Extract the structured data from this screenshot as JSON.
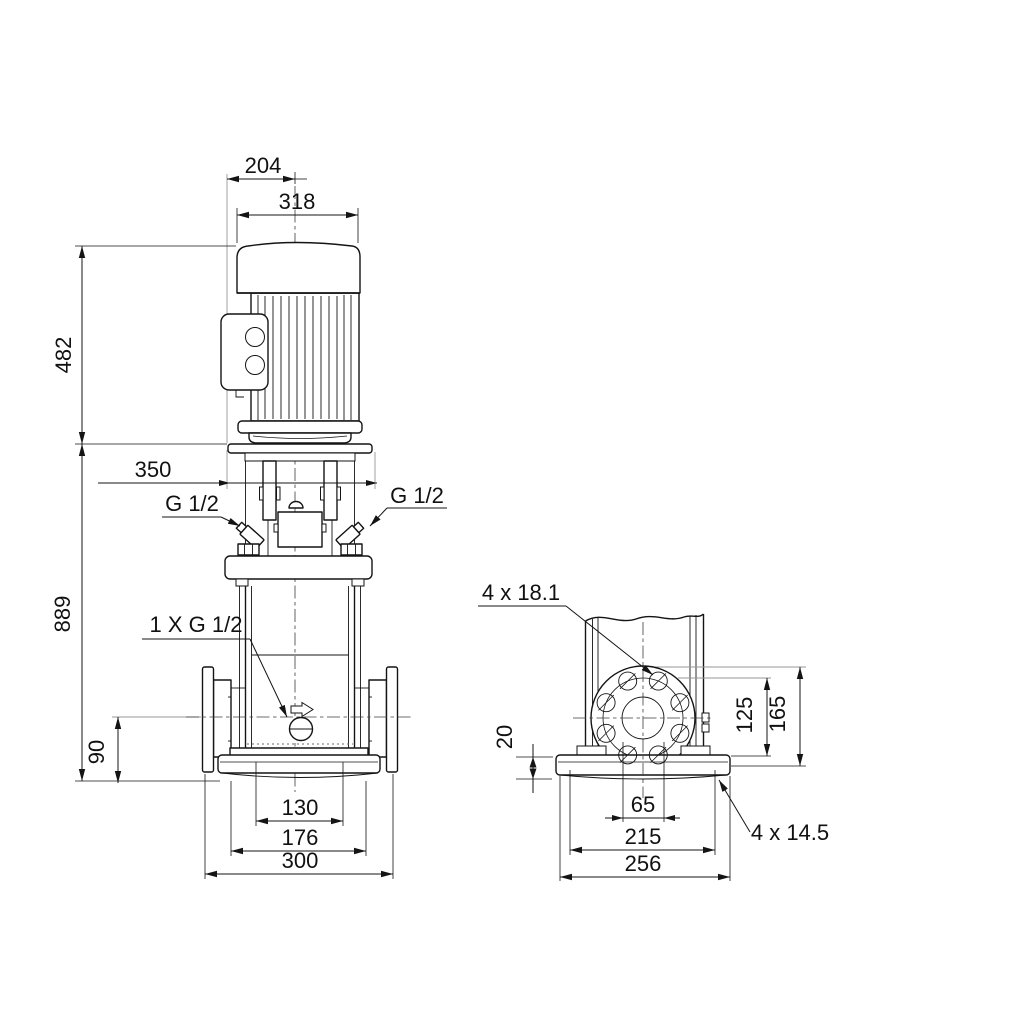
{
  "drawing": {
    "type": "technical-dimensional-drawing",
    "subject": "vertical multistage inline pump, two projection views with dimensions in mm",
    "colors": {
      "line": "#141414",
      "background": "#ffffff",
      "aux_line": "#979797"
    },
    "front_view": {
      "dims": {
        "width_top": "204",
        "width_motor": "318",
        "height_motor": "482",
        "width_stool": "350",
        "height_total": "889",
        "height_port": "90",
        "width_inner": "130",
        "width_mid": "176",
        "width_base": "300"
      },
      "labels": {
        "g12_left": "G 1/2",
        "g12_right": "G 1/2",
        "drain": "1 X G 1/2"
      }
    },
    "side_view": {
      "dims": {
        "base_height": "20",
        "bolt_span_vertical": "125",
        "base_depth": "165",
        "port_bore": "65",
        "base_bolt_span": "215",
        "base_width": "256"
      },
      "labels": {
        "flange_holes": "4 x 18.1",
        "base_holes": "4 x 14.5"
      }
    }
  }
}
